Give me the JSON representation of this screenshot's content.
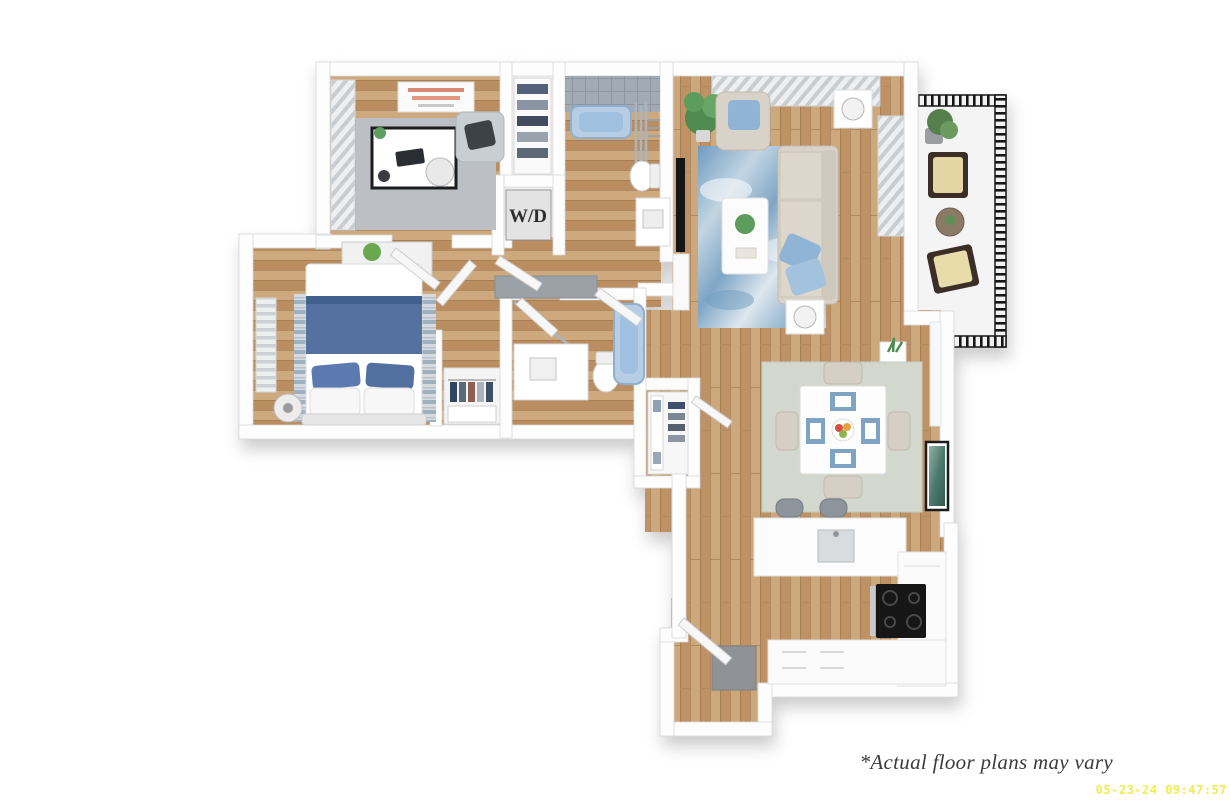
{
  "image": {
    "kind": "3D apartment floor plan render",
    "width": 1231,
    "height": 807
  },
  "plan": {
    "wd_label": "W/D",
    "rooms": [
      "office",
      "linen-closet",
      "bathroom",
      "washer-dryer-closet",
      "living-room",
      "balcony",
      "bedroom",
      "second-bathroom",
      "walk-in-closet",
      "hallway",
      "dining-area",
      "kitchen",
      "entry"
    ]
  },
  "footer": {
    "disclaimer": "*Actual floor plans may vary",
    "timestamp": "05-23-24 09:47:57"
  },
  "colors": {
    "background": "#ffffff",
    "wall": "#fdfdfd",
    "wood_floor": "#c49a6c",
    "accent_blue": "#8fb4d6",
    "bedding_navy": "#54719f",
    "tub_blue": "#b6cde4",
    "balcony_metal": "#161616",
    "stove_black": "#121212",
    "rug_living_blue": "#7ea6c6",
    "rug_office_gray": "#bcc0c4",
    "rug_dining_sage": "#d2d8cd",
    "disclaimer_text": "#3b3b3b",
    "timestamp_yellow": "#f0e93c"
  }
}
